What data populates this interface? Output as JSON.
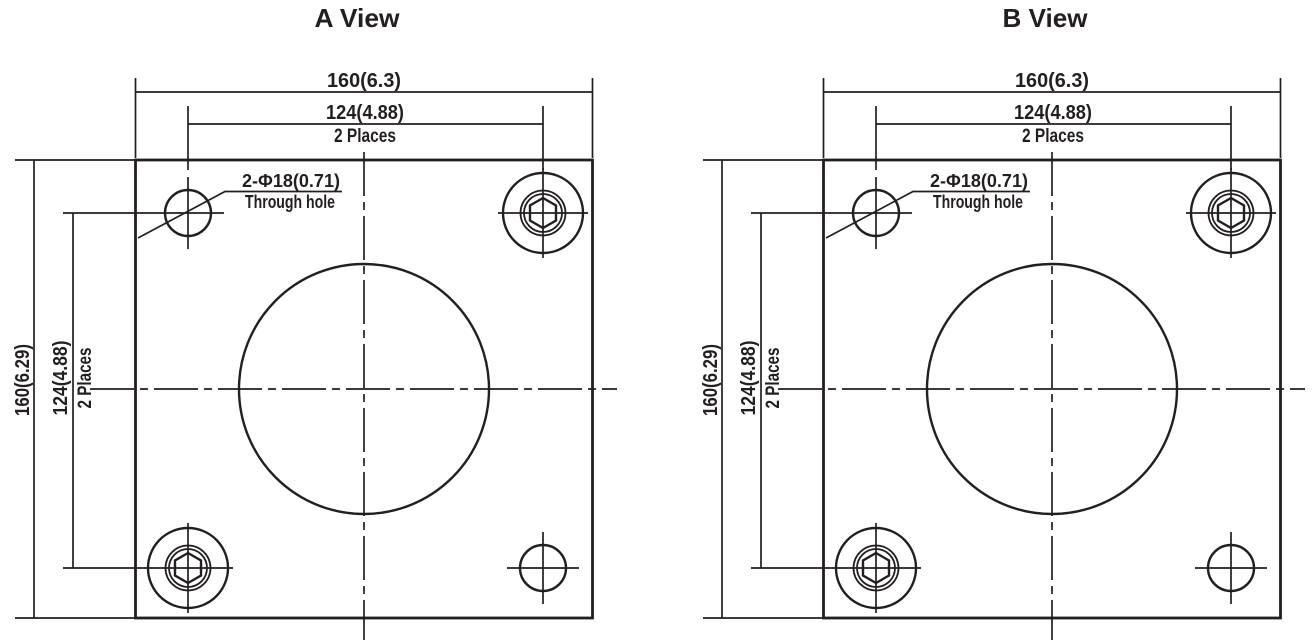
{
  "drawing": {
    "background_color": "#ffffff",
    "line_color": "#231f20",
    "type": "flange-plate-two-views"
  },
  "views": [
    {
      "id": "a",
      "title": "A View"
    },
    {
      "id": "b",
      "title": "B View"
    }
  ],
  "dims": {
    "overall_width": "160(6.3)",
    "hole_spacing_horizontal": "124(4.88)",
    "hole_spacing_places_h": "2 Places",
    "overall_height": "160(6.29)",
    "hole_spacing_vertical": "124(4.88)",
    "hole_spacing_places_v": "2 Places",
    "hole_callout_diameter": "2-Φ18(0.71)",
    "hole_callout_type": "Through hole"
  }
}
